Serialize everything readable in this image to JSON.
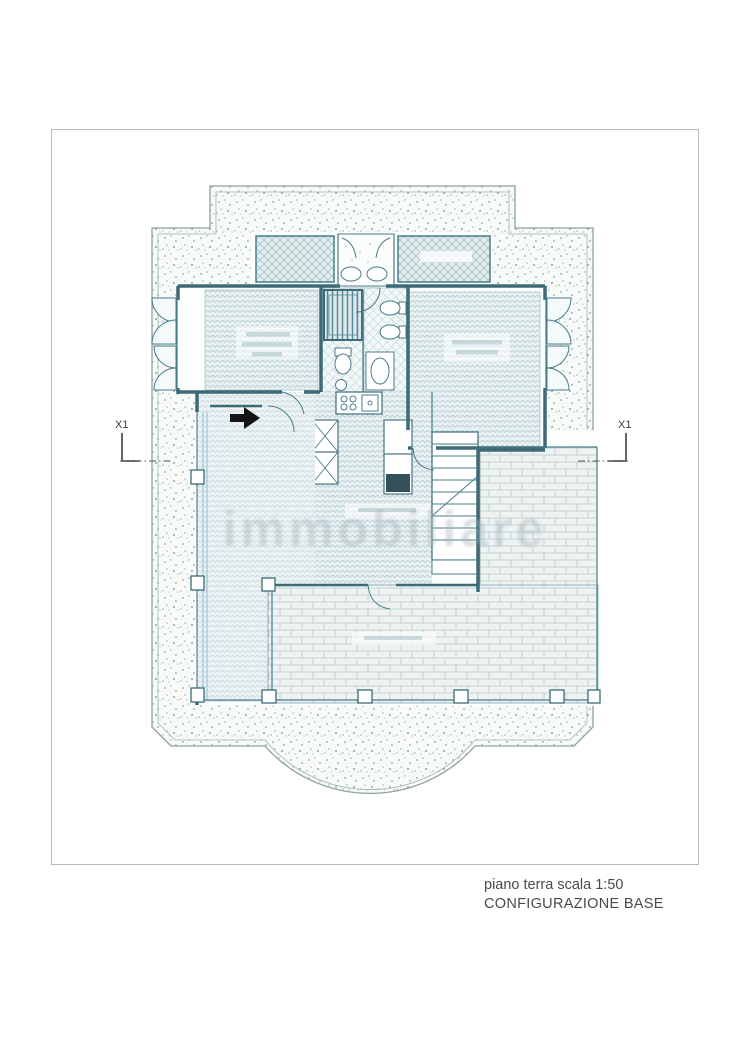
{
  "document": {
    "caption": {
      "line1": "piano terra scala 1:50",
      "line2": "CONFIGURAZIONE BASE"
    },
    "watermark": "immobiliare",
    "plan": {
      "section_markers": {
        "left": "X1",
        "right": "X1"
      }
    },
    "colors": {
      "drawing_line": "#41707e",
      "wall": "#3c6a77",
      "pattern_line": "#bdd2d7",
      "stipple_dot": "#9fb5ad",
      "arrow": "#151515",
      "sheet_border": "#b3bcbc",
      "caption_text": "#4a4a4a"
    }
  }
}
